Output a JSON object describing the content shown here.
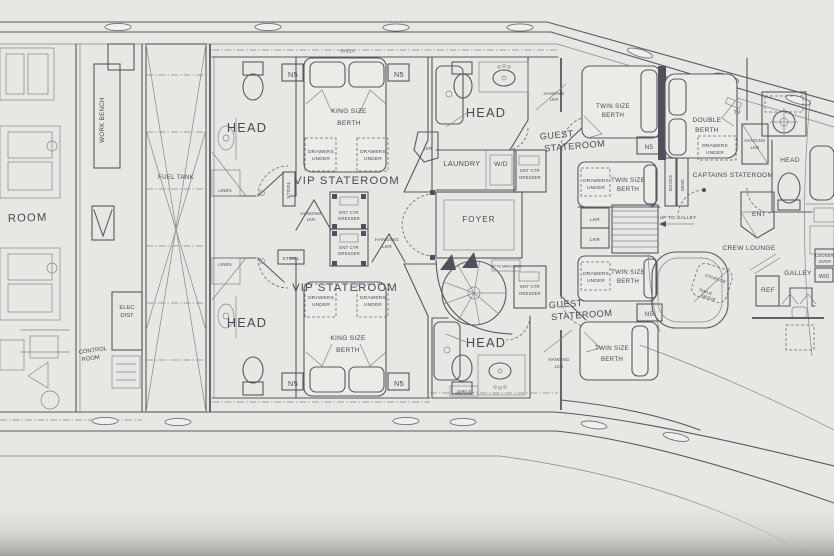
{
  "colors": {
    "paper": "#e9e7e3",
    "ink": "#474854",
    "wall": "#565861"
  },
  "labels": {
    "room": "ROOM",
    "work_bench": "WORK BENCH",
    "fuel_tank": "FUEL TANK",
    "elec": "ELEC",
    "dist": "DIST",
    "control": "CONTROL",
    "head": "HEAD",
    "linen": "LINEN",
    "stool": "STOOL",
    "n5": "N5",
    "king_size": "KING SIZE",
    "twin_size": "TWIN SIZE",
    "berth": "BERTH",
    "double": "DOUBLE",
    "drawers": "DRAWERS",
    "under": "UNDER",
    "hanging": "HANGING",
    "lkr": "LKR",
    "ent_ctr": "ENT CTR",
    "dresser": "DRESSER",
    "vip_stateroom": "VIP STATEROOM",
    "guest": "GUEST",
    "stateroom": "STATEROOM",
    "captains_stateroom": "CAPTAINS STATEROOM",
    "crew_lounge": "CREW LOUNGE",
    "tv": "TV",
    "foyer": "FOYER",
    "laundry": "LAUNDRY",
    "wd": "W/D",
    "up_to_main_deck": "UP TO MAIN DECK",
    "up_to_galley": "UP TO GALLEY",
    "galley": "GALLEY",
    "ref": "REF",
    "lockers": "LOCKERS",
    "over": "OVER",
    "ent": "ENT",
    "books": "BOOKS",
    "desk": "DESK",
    "storage": "STORAGE",
    "table": "TABLE",
    "above": "ABOVE",
    "shelf": "SHELF"
  }
}
